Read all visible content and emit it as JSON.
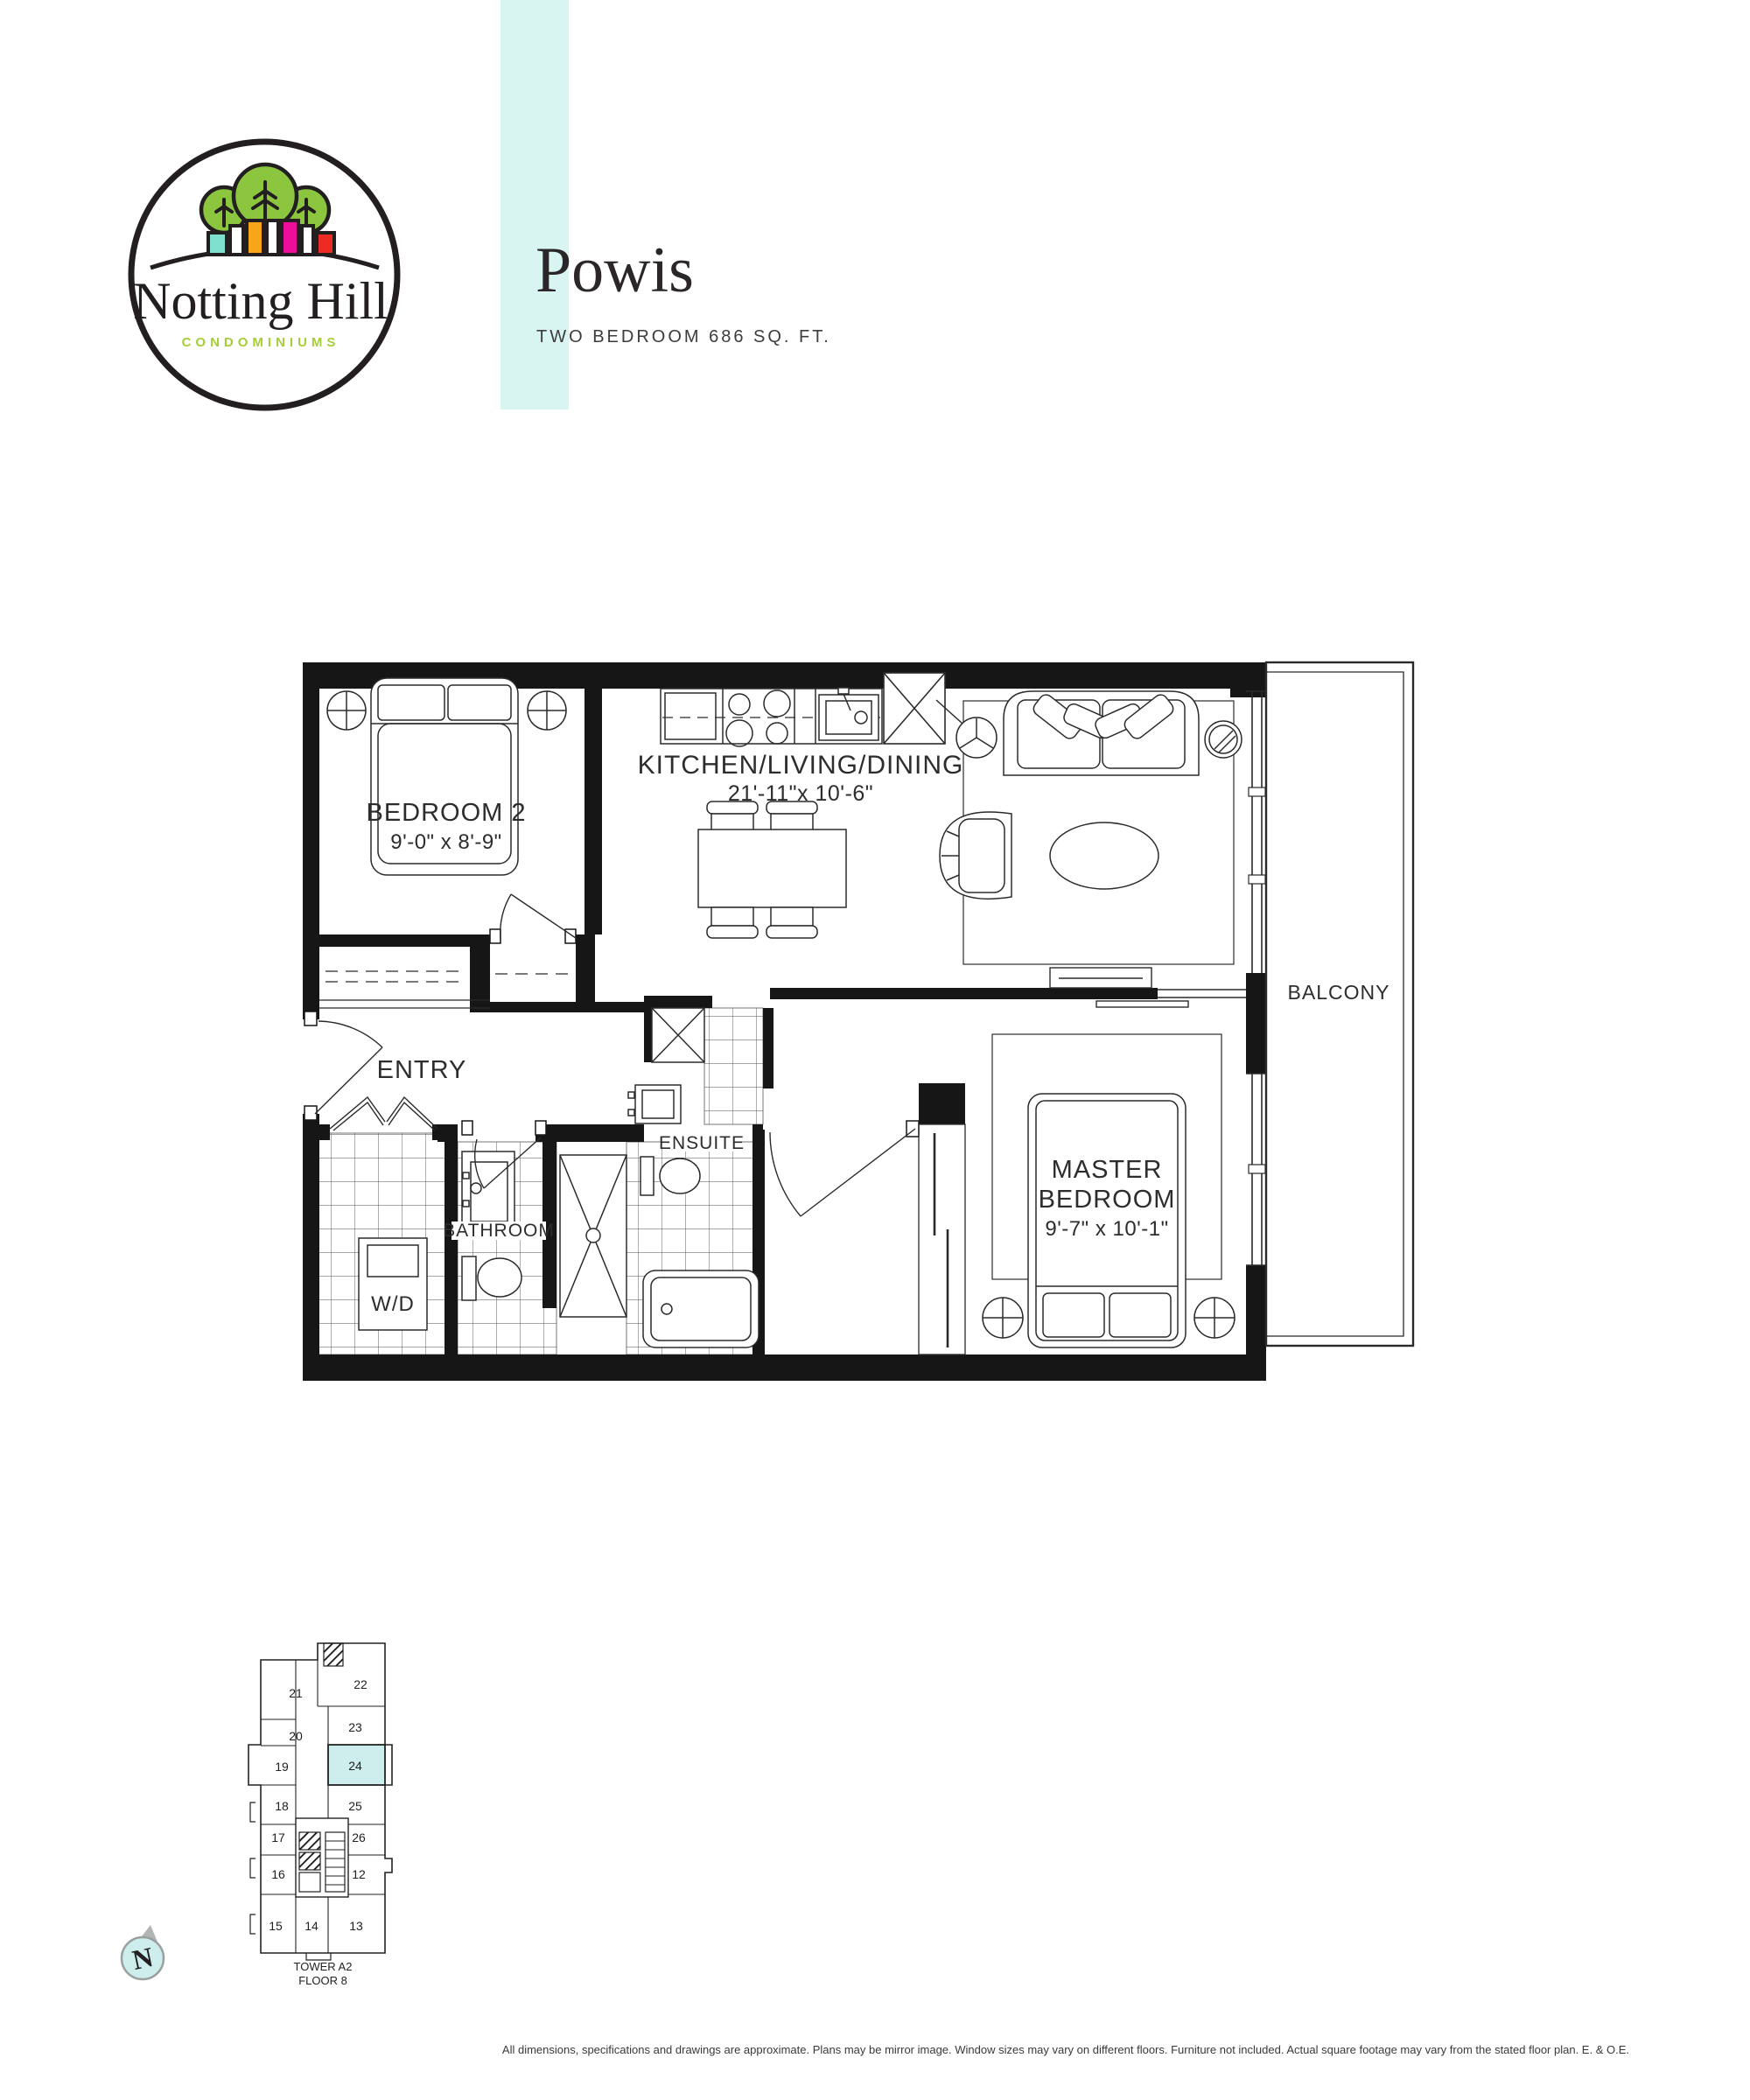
{
  "brand": {
    "name": "Notting Hill",
    "tagline": "CONDOMINIUMS"
  },
  "header": {
    "title": "Powis",
    "subtitle": "TWO BEDROOM 686 SQ. FT."
  },
  "plan": {
    "bedroom2": {
      "name": "BEDROOM 2",
      "dims": "9'-0\" x 8'-9\""
    },
    "kitchen": {
      "name": "KITCHEN/LIVING/DINING",
      "dims": "21'-11\"x 10'-6\""
    },
    "entry": {
      "name": "ENTRY"
    },
    "wd": {
      "name": "W/D"
    },
    "bathroom": {
      "name": "BATHROOM"
    },
    "ensuite": {
      "name": "ENSUITE"
    },
    "master": {
      "name_line1": "MASTER",
      "name_line2": "BEDROOM",
      "dims": "9'-7\" x 10'-1\""
    },
    "balcony": {
      "name": "BALCONY"
    }
  },
  "keyplan": {
    "units": [
      "21",
      "22",
      "20",
      "23",
      "19",
      "24",
      "18",
      "25",
      "17",
      "26",
      "16",
      "12",
      "15",
      "14",
      "13"
    ],
    "highlighted_unit": "24",
    "tower": "TOWER A2",
    "floor": "FLOOR 8",
    "compass_label": "N"
  },
  "disclaimer": "All dimensions, specifications and drawings are approximate. Plans may be mirror image. Window sizes may vary on different floors. Furniture not included. Actual square footage may vary from the stated floor plan. E. & O.E.",
  "colors": {
    "stripe": "#d8f5f2",
    "unit_highlight": "#cdeeec",
    "logo_green": "#8cc63e",
    "brand_green": "#a6ce39",
    "logo_teal": "#7fe0d0",
    "logo_orange": "#f9a51a",
    "logo_magenta": "#ec0d9b",
    "logo_red": "#ee2a24",
    "ink": "#231f20"
  }
}
